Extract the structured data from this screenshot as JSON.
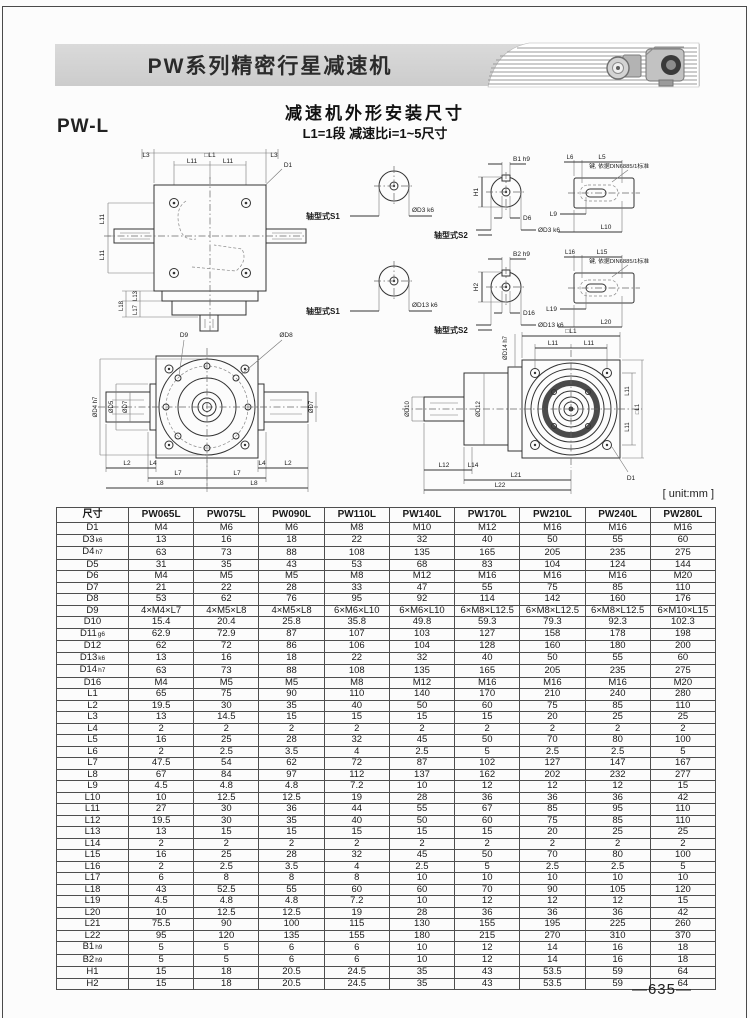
{
  "header": {
    "title": "PW系列精密行星减速机"
  },
  "intro": {
    "model": "PW-L",
    "title": "减速机外形安装尺寸",
    "subtitle": "L1=1段 减速比i=1~5尺寸"
  },
  "footer": {
    "unit": "[ unit:mm ]",
    "page": "—635—"
  },
  "drw": {
    "front": {
      "l3a": "L3",
      "l1": "□L1",
      "l3b": "L3",
      "l11a": "L11",
      "l11b": "L11",
      "d1": "D1",
      "l11c": "L11",
      "l11d": "L11",
      "l18": "L18",
      "l13": "L13",
      "l17": "L17"
    },
    "row1": {
      "s1": "轴型式S1",
      "s1dia": "ØD3 k6",
      "s2": "轴型式S2",
      "b": "B1 h9",
      "h": "H1",
      "d": "D6",
      "s2dia": "ØD3 k6",
      "t1": "L6",
      "t2": "L5",
      "b1": "L9",
      "b2": "L10",
      "note": "键, 依据DIN6885/1标准"
    },
    "row2": {
      "s1": "轴型式S1",
      "s1dia": "ØD13 k6",
      "s2": "轴型式S2",
      "b": "B2 h9",
      "h": "H2",
      "d": "D16",
      "s2dia": "ØD13 k6",
      "t1": "L16",
      "t2": "L15",
      "b1": "L19",
      "b2": "L20",
      "note": "键, 依据DIN6885/1标准"
    },
    "top": {
      "d9": "D9",
      "d8": "ØD8",
      "d4": "ØD4 h7",
      "d5": "ØD5",
      "d7l": "ØD7",
      "d7r": "ØD7",
      "l2a": "L2",
      "l4a": "L4",
      "l4b": "L4",
      "l2b": "L2",
      "l7a": "L7",
      "l7b": "L7",
      "l8a": "L8",
      "l8b": "L8"
    },
    "side": {
      "l1": "□L1",
      "l11a": "L11",
      "l11b": "L11",
      "d14": "ØD14 h7",
      "d12": "ØD12",
      "d10": "ØD10",
      "l11c": "L11",
      "l11d": "L11",
      "l1r": "□L1",
      "d1": "D1",
      "l12": "L12",
      "l14": "L14",
      "l21": "L21",
      "l22": "L22"
    }
  },
  "table": {
    "columns": [
      "尺寸",
      "PW065L",
      "PW075L",
      "PW090L",
      "PW110L",
      "PW140L",
      "PW170L",
      "PW210L",
      "PW240L",
      "PW280L"
    ],
    "rows": [
      {
        "dim": "D1",
        "sub": "",
        "values": [
          "M4",
          "M6",
          "M6",
          "M8",
          "M10",
          "M12",
          "M16",
          "M16",
          "M16"
        ]
      },
      {
        "dim": "D3",
        "sub": "k6",
        "values": [
          "13",
          "16",
          "18",
          "22",
          "32",
          "40",
          "50",
          "55",
          "60"
        ]
      },
      {
        "dim": "D4",
        "sub": "h7",
        "values": [
          "63",
          "73",
          "88",
          "108",
          "135",
          "165",
          "205",
          "235",
          "275"
        ]
      },
      {
        "dim": "D5",
        "sub": "",
        "values": [
          "31",
          "35",
          "43",
          "53",
          "68",
          "83",
          "104",
          "124",
          "144"
        ]
      },
      {
        "dim": "D6",
        "sub": "",
        "values": [
          "M4",
          "M5",
          "M5",
          "M8",
          "M12",
          "M16",
          "M16",
          "M16",
          "M20"
        ]
      },
      {
        "dim": "D7",
        "sub": "",
        "values": [
          "21",
          "22",
          "28",
          "33",
          "47",
          "55",
          "75",
          "85",
          "110"
        ]
      },
      {
        "dim": "D8",
        "sub": "",
        "values": [
          "53",
          "62",
          "76",
          "95",
          "92",
          "114",
          "142",
          "160",
          "176"
        ]
      },
      {
        "dim": "D9",
        "sub": "",
        "values": [
          "4×M4×L7",
          "4×M5×L8",
          "4×M5×L8",
          "6×M6×L10",
          "6×M6×L10",
          "6×M8×L12.5",
          "6×M8×L12.5",
          "6×M8×L12.5",
          "6×M10×L15"
        ]
      },
      {
        "dim": "D10",
        "sub": "",
        "values": [
          "15.4",
          "20.4",
          "25.8",
          "35.8",
          "49.8",
          "59.3",
          "79.3",
          "92.3",
          "102.3"
        ]
      },
      {
        "dim": "D11",
        "sub": "g6",
        "values": [
          "62.9",
          "72.9",
          "87",
          "107",
          "103",
          "127",
          "158",
          "178",
          "198"
        ]
      },
      {
        "dim": "D12",
        "sub": "",
        "values": [
          "62",
          "72",
          "86",
          "106",
          "104",
          "128",
          "160",
          "180",
          "200"
        ]
      },
      {
        "dim": "D13",
        "sub": "k6",
        "values": [
          "13",
          "16",
          "18",
          "22",
          "32",
          "40",
          "50",
          "55",
          "60"
        ]
      },
      {
        "dim": "D14",
        "sub": "h7",
        "values": [
          "63",
          "73",
          "88",
          "108",
          "135",
          "165",
          "205",
          "235",
          "275"
        ]
      },
      {
        "dim": "D16",
        "sub": "",
        "values": [
          "M4",
          "M5",
          "M5",
          "M8",
          "M12",
          "M16",
          "M16",
          "M16",
          "M20"
        ]
      },
      {
        "dim": "L1",
        "sub": "",
        "values": [
          "65",
          "75",
          "90",
          "110",
          "140",
          "170",
          "210",
          "240",
          "280"
        ]
      },
      {
        "dim": "L2",
        "sub": "",
        "values": [
          "19.5",
          "30",
          "35",
          "40",
          "50",
          "60",
          "75",
          "85",
          "110"
        ]
      },
      {
        "dim": "L3",
        "sub": "",
        "values": [
          "13",
          "14.5",
          "15",
          "15",
          "15",
          "15",
          "20",
          "25",
          "25"
        ]
      },
      {
        "dim": "L4",
        "sub": "",
        "values": [
          "2",
          "2",
          "2",
          "2",
          "2",
          "2",
          "2",
          "2",
          "2"
        ]
      },
      {
        "dim": "L5",
        "sub": "",
        "values": [
          "16",
          "25",
          "28",
          "32",
          "45",
          "50",
          "70",
          "80",
          "100"
        ]
      },
      {
        "dim": "L6",
        "sub": "",
        "values": [
          "2",
          "2.5",
          "3.5",
          "4",
          "2.5",
          "5",
          "2.5",
          "2.5",
          "5"
        ]
      },
      {
        "dim": "L7",
        "sub": "",
        "values": [
          "47.5",
          "54",
          "62",
          "72",
          "87",
          "102",
          "127",
          "147",
          "167"
        ]
      },
      {
        "dim": "L8",
        "sub": "",
        "values": [
          "67",
          "84",
          "97",
          "112",
          "137",
          "162",
          "202",
          "232",
          "277"
        ]
      },
      {
        "dim": "L9",
        "sub": "",
        "values": [
          "4.5",
          "4.8",
          "4.8",
          "7.2",
          "10",
          "12",
          "12",
          "12",
          "15"
        ]
      },
      {
        "dim": "L10",
        "sub": "",
        "values": [
          "10",
          "12.5",
          "12.5",
          "19",
          "28",
          "36",
          "36",
          "36",
          "42"
        ]
      },
      {
        "dim": "L11",
        "sub": "",
        "values": [
          "27",
          "30",
          "36",
          "44",
          "55",
          "67",
          "85",
          "95",
          "110"
        ]
      },
      {
        "dim": "L12",
        "sub": "",
        "values": [
          "19.5",
          "30",
          "35",
          "40",
          "50",
          "60",
          "75",
          "85",
          "110"
        ]
      },
      {
        "dim": "L13",
        "sub": "",
        "values": [
          "13",
          "15",
          "15",
          "15",
          "15",
          "15",
          "20",
          "25",
          "25"
        ]
      },
      {
        "dim": "L14",
        "sub": "",
        "values": [
          "2",
          "2",
          "2",
          "2",
          "2",
          "2",
          "2",
          "2",
          "2"
        ]
      },
      {
        "dim": "L15",
        "sub": "",
        "values": [
          "16",
          "25",
          "28",
          "32",
          "45",
          "50",
          "70",
          "80",
          "100"
        ]
      },
      {
        "dim": "L16",
        "sub": "",
        "values": [
          "2",
          "2.5",
          "3.5",
          "4",
          "2.5",
          "5",
          "2.5",
          "2.5",
          "5"
        ]
      },
      {
        "dim": "L17",
        "sub": "",
        "values": [
          "6",
          "8",
          "8",
          "8",
          "10",
          "10",
          "10",
          "10",
          "10"
        ]
      },
      {
        "dim": "L18",
        "sub": "",
        "values": [
          "43",
          "52.5",
          "55",
          "60",
          "60",
          "70",
          "90",
          "105",
          "120"
        ]
      },
      {
        "dim": "L19",
        "sub": "",
        "values": [
          "4.5",
          "4.8",
          "4.8",
          "7.2",
          "10",
          "12",
          "12",
          "12",
          "15"
        ]
      },
      {
        "dim": "L20",
        "sub": "",
        "values": [
          "10",
          "12.5",
          "12.5",
          "19",
          "28",
          "36",
          "36",
          "36",
          "42"
        ]
      },
      {
        "dim": "L21",
        "sub": "",
        "values": [
          "75.5",
          "90",
          "100",
          "115",
          "130",
          "155",
          "195",
          "225",
          "260"
        ]
      },
      {
        "dim": "L22",
        "sub": "",
        "values": [
          "95",
          "120",
          "135",
          "155",
          "180",
          "215",
          "270",
          "310",
          "370"
        ]
      },
      {
        "dim": "B1",
        "sub": "h9",
        "values": [
          "5",
          "5",
          "6",
          "6",
          "10",
          "12",
          "14",
          "16",
          "18"
        ]
      },
      {
        "dim": "B2",
        "sub": "h9",
        "values": [
          "5",
          "5",
          "6",
          "6",
          "10",
          "12",
          "14",
          "16",
          "18"
        ]
      },
      {
        "dim": "H1",
        "sub": "",
        "values": [
          "15",
          "18",
          "20.5",
          "24.5",
          "35",
          "43",
          "53.5",
          "59",
          "64"
        ]
      },
      {
        "dim": "H2",
        "sub": "",
        "values": [
          "15",
          "18",
          "20.5",
          "24.5",
          "35",
          "43",
          "53.5",
          "59",
          "64"
        ]
      }
    ]
  }
}
